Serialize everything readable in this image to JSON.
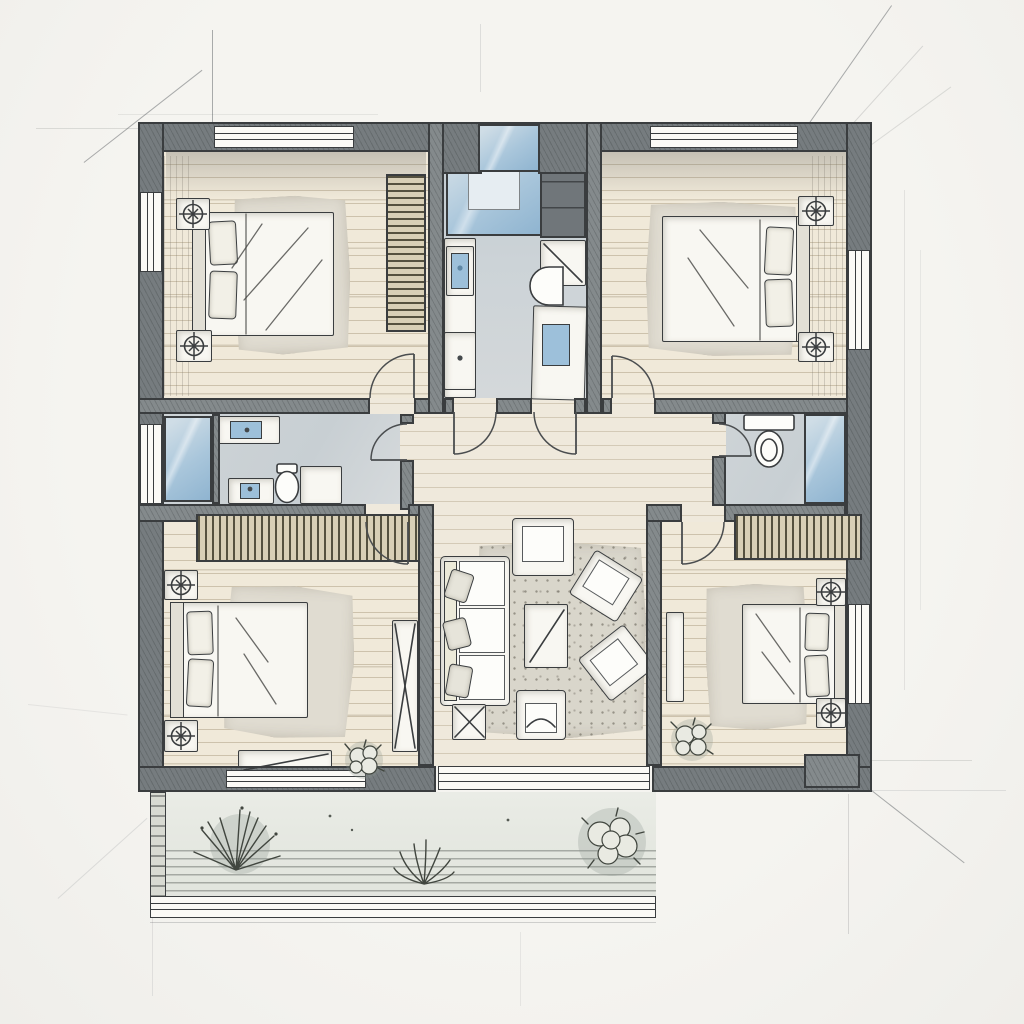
{
  "document": {
    "type": "architectural floor plan",
    "style": "hand-drawn ink and watercolor sketch",
    "view": "top-down plan of a residence with four bedrooms, three bathrooms, central living room and rear patio"
  },
  "palette": {
    "paper": "#f3f2ee",
    "ink": "#3a3d3f",
    "wall": "#848a8c",
    "wallDark": "#767c7f",
    "floorWood": "#f0e9d9",
    "floorHall": "#efe9dc",
    "floorLine": "rgba(140,122,88,0.35)",
    "floorBath": "#ccd3d7",
    "glass": "#a9c6db",
    "glassLight": "#cfdde6",
    "glassDeep": "#8fb4d0",
    "fixtureBlue": "#9dc0da",
    "rug": "#e0dcd1",
    "rugLiving": "#d9d6cb",
    "furniture": "#f8f7f2",
    "furnShade": "#d9d6cc",
    "louver": "#d8cfb6",
    "louverLine": "#55513f",
    "patio": "#e4e7e0",
    "patioDeckLine": "rgba(90,95,90,0.45)",
    "plantInk": "#41463f",
    "sketchLine": "rgba(75,80,85,0.45)"
  },
  "rooms": {
    "bedroom_top_left": {
      "label": "bedroom",
      "furniture": [
        "double-bed",
        "nightstand-with-lamp",
        "nightstand-with-lamp",
        "area-rug",
        "louvered-wardrobe"
      ],
      "openings": [
        "window-top",
        "window-left",
        "door-to-hallway"
      ]
    },
    "bathroom_center": {
      "label": "bathroom / utility",
      "furniture": [
        "glazed-shower",
        "tall-cabinet",
        "shelf",
        "counter-with-two-sinks",
        "wall-urinal",
        "vanity-with-sink"
      ],
      "openings": [
        "skylight",
        "door-to-hallway",
        "door-to-hallway"
      ]
    },
    "bedroom_top_right": {
      "label": "bedroom",
      "furniture": [
        "double-bed",
        "nightstand-with-lamp",
        "nightstand-with-lamp",
        "area-rug"
      ],
      "openings": [
        "window-top",
        "window-right",
        "door-to-hallway"
      ]
    },
    "bathroom_mid_left": {
      "label": "bathroom",
      "furniture": [
        "glazed-shower",
        "sink",
        "sink",
        "toilet",
        "shower-tray",
        "louvered-closet"
      ],
      "openings": [
        "window-left",
        "door-to-hallway"
      ]
    },
    "bathroom_mid_right": {
      "label": "bathroom",
      "furniture": [
        "toilet-with-tank",
        "glazed-shower",
        "louvered-closet"
      ],
      "openings": [
        "door-to-hallway"
      ]
    },
    "bedroom_bottom_left": {
      "label": "bedroom",
      "furniture": [
        "double-bed",
        "nightstand-with-lamp",
        "nightstand-with-lamp",
        "area-rug",
        "bench",
        "tall-wardrobe",
        "potted-plant"
      ],
      "openings": [
        "door-to-hallway",
        "glazed-wall-to-patio"
      ]
    },
    "living_room": {
      "label": "living room",
      "furniture": [
        "three-seat-sofa",
        "armchair",
        "coffee-table",
        "angled-armchair",
        "angled-armchair",
        "side-chair",
        "ottoman",
        "speckled-rug"
      ],
      "openings": [
        "open-to-hallway",
        "threshold-to-patio"
      ]
    },
    "bedroom_bottom_right": {
      "label": "bedroom",
      "furniture": [
        "double-bed",
        "nightstand-with-lamp",
        "nightstand-with-lamp",
        "area-rug",
        "wall-console",
        "potted-plant",
        "outdoor-bench"
      ],
      "openings": [
        "window-right",
        "door-to-hallway"
      ]
    },
    "patio": {
      "label": "rear patio / deck",
      "furniture": [
        "spiky-plant",
        "grass-clump",
        "bush"
      ],
      "openings": []
    }
  },
  "annotations": {
    "construction_lines": "pencil extension lines radiating from plan corners",
    "door_swings": 8,
    "lamp_symbols": 8
  }
}
